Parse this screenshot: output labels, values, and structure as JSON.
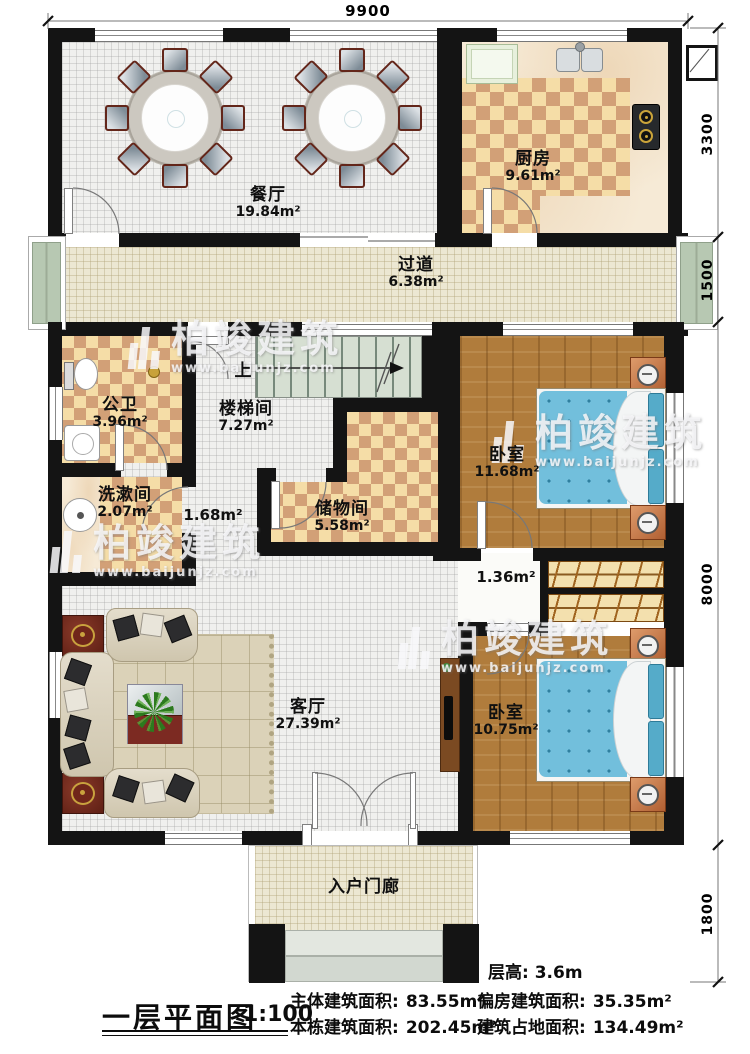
{
  "plan": {
    "watermark": {
      "brand": "柏竣建筑",
      "url": "www.baijunjz.com"
    },
    "dimensions": {
      "top": "9900",
      "side_top": "3300",
      "side_corridor": "1500",
      "side_main": "8000",
      "side_porch": "1800"
    },
    "rooms": {
      "dining": {
        "name": "餐厅",
        "area": "19.84m²"
      },
      "kitchen": {
        "name": "厨房",
        "area": "9.61m²"
      },
      "corridor": {
        "name": "过道",
        "area": "6.38m²"
      },
      "bathroom": {
        "name": "公卫",
        "area": "3.96m²"
      },
      "stairwell": {
        "name": "楼梯间",
        "area": "7.27m²"
      },
      "washroom": {
        "name": "洗漱间",
        "area": "2.07m²"
      },
      "storage": {
        "name": "储物间",
        "area": "5.58m²"
      },
      "bedroom1": {
        "name": "卧室",
        "area": "11.68m²"
      },
      "living": {
        "name": "客厅",
        "area": "27.39m²"
      },
      "bedroom2": {
        "name": "卧室",
        "area": "10.75m²"
      },
      "porch": {
        "name": "入户门廊"
      }
    },
    "labels": {
      "hall_small": "1.68m²",
      "hall_bedroom": "1.36m²",
      "stairs_up": "上"
    },
    "footer": {
      "title": "一层平面图",
      "scale": "1:100",
      "floor_height": "层高: 3.6m",
      "stats": [
        {
          "label": "主体建筑面积:",
          "value": "83.55m²"
        },
        {
          "label": "偏房建筑面积:",
          "value": "35.35m²"
        },
        {
          "label": "本栋建筑面积:",
          "value": "202.45m²"
        },
        {
          "label": "建筑占地面积:",
          "value": "134.49m²"
        }
      ]
    }
  }
}
